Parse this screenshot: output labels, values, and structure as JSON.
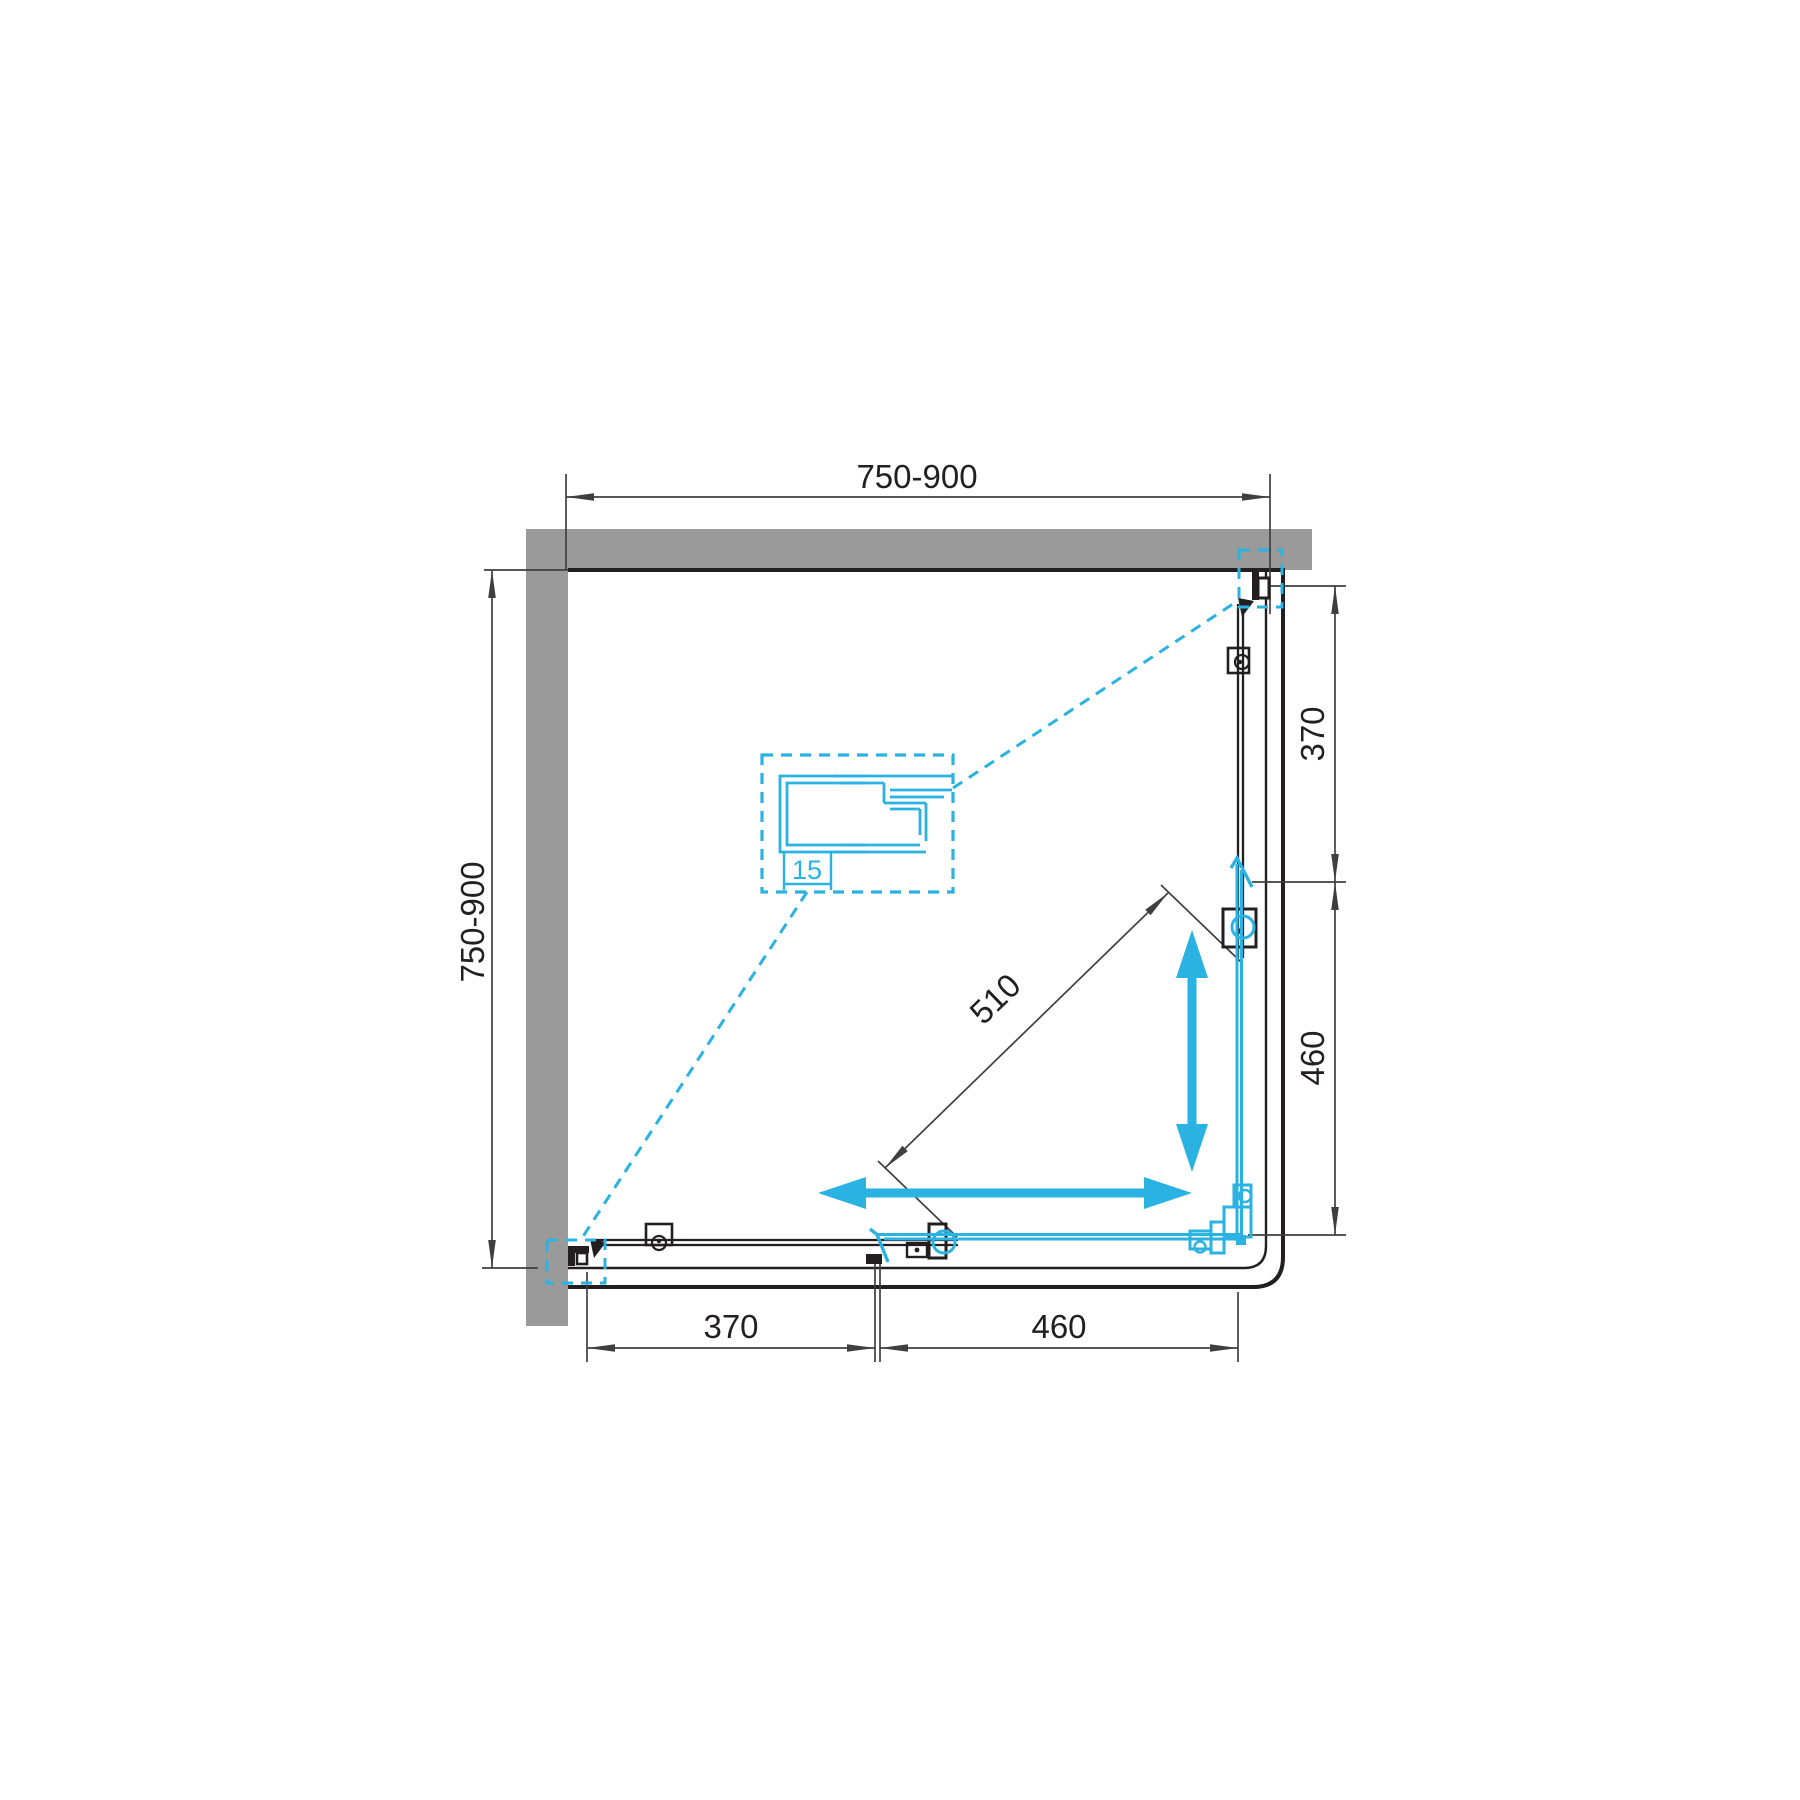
{
  "title": "Corner shower enclosure plan view drawing",
  "colors": {
    "accent_cyan": "#2AB2E2",
    "wall_gray": "#9A9A9A",
    "line_black": "#231F20",
    "dim_line": "#3F3F3F"
  },
  "dimensions": {
    "top_width": "750-900",
    "left_depth": "750-900",
    "right_fixed_panel": "370",
    "right_door_opening": "460",
    "bottom_fixed_panel": "370",
    "bottom_door_opening": "460",
    "diagonal_entry": "510",
    "profile_adjustment": "15"
  }
}
